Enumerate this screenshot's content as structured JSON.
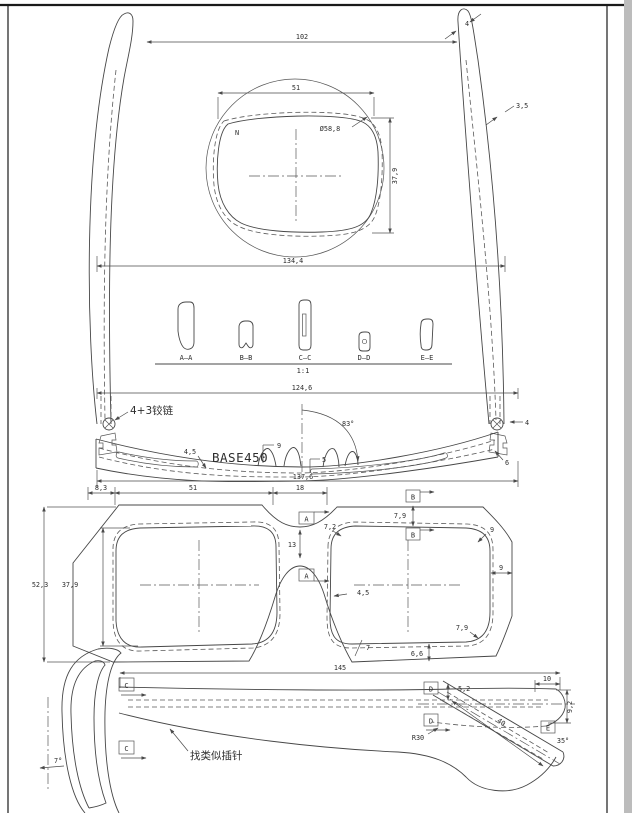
{
  "page": {
    "background": "#ffffff",
    "line_color": "#474747",
    "border_color": "#1a1a1a",
    "edge_strip_color": "#bcbcbc"
  },
  "drawing": {
    "unfolded_view": {
      "dim_temple_span": "102",
      "dim_lens_width": "51",
      "dim_lens_circle": "Ø58,8",
      "dim_lens_height": "37,9",
      "dim_overall_width": "134,4",
      "dim_tip_thickness": "4",
      "dim_temple_thickness": "3,5",
      "lens_mark": "N"
    },
    "sections": {
      "a": "A—A",
      "b": "B—B",
      "c": "C—C",
      "d": "D—D",
      "e": "E—E",
      "scale": "1:1"
    },
    "top_view": {
      "dim_hinge_span": "124,6",
      "hinge_note": "4+3铰链",
      "dim_front_thickness": "4,5",
      "base_label": "BASE450",
      "dim_pad_height": "9",
      "dim_pad_depth": "5",
      "dim_open_angle": "83°",
      "dim_temple_width": "4",
      "dim_hinge_inset": "6",
      "dim_front_width": "137,6"
    },
    "front_view": {
      "dim_end_piece": "8,3",
      "dim_lens_width": "51",
      "dim_bridge": "18",
      "dim_frame_height": "52,3",
      "dim_lens_height": "37,9",
      "dim_bridge_thickness": "13",
      "dim_rim_inner_top": "7,2",
      "dim_rim_top": "7,9",
      "dim_corner_top": "9",
      "dim_rim_side": "9",
      "dim_corner_bottom": "7,9",
      "dim_rim_bottom": "6,6",
      "dim_rim_nose": "4,5",
      "dim_rim_bottom_left": "7",
      "marker_a": "A",
      "marker_b": "B"
    },
    "side_view": {
      "dim_temple_length": "145",
      "dim_front_tilt": "7°",
      "marker_c": "C",
      "marker_d": "D",
      "marker_e": "E",
      "pin_note": "找类似插针",
      "dim_tip_height": "5,2",
      "dim_bend_radius": "R30",
      "dim_tip_length": "40",
      "dim_tip_end": "10",
      "dim_tip_drop": "9,2",
      "dim_tip_angle": "35°"
    }
  }
}
